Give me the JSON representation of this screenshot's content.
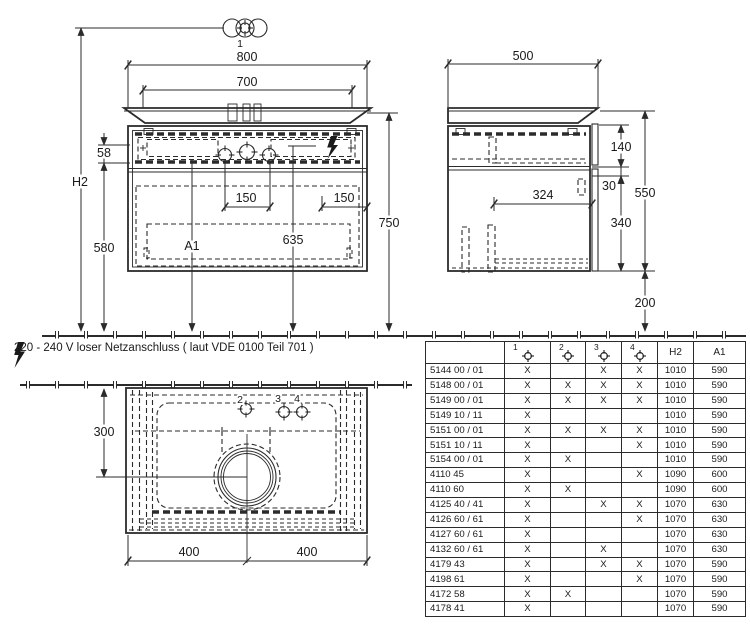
{
  "note": {
    "voltage_text": "220 - 240 V loser Netzanschluss ( laut VDE 0100 Teil 701 )"
  },
  "views": {
    "front": {
      "labels": {
        "hole1": "1",
        "w800": "800",
        "w700": "700",
        "h58": "58",
        "hH2": "H2",
        "h580": "580",
        "h750": "750",
        "d150_left": "150",
        "d150_right": "150",
        "a1": "A1",
        "d635": "635"
      }
    },
    "side": {
      "labels": {
        "w500": "500",
        "d140": "140",
        "d30": "30",
        "d340": "340",
        "d550": "550",
        "d200": "200",
        "d324": "324"
      }
    },
    "plan": {
      "labels": {
        "d300": "300",
        "d400_left": "400",
        "d400_right": "400",
        "hole2": "2",
        "hole3": "3",
        "hole4": "4"
      }
    }
  },
  "table": {
    "hole_headers": [
      "1",
      "2",
      "3",
      "4"
    ],
    "text_headers": [
      "H2",
      "A1"
    ],
    "rows": [
      {
        "article": "5144 00 / 01",
        "c1": "X",
        "c2": "",
        "c3": "X",
        "c4": "X",
        "h2": "1010",
        "a1": "590"
      },
      {
        "article": "5148 00 / 01",
        "c1": "X",
        "c2": "X",
        "c3": "X",
        "c4": "X",
        "h2": "1010",
        "a1": "590"
      },
      {
        "article": "5149 00 / 01",
        "c1": "X",
        "c2": "X",
        "c3": "X",
        "c4": "X",
        "h2": "1010",
        "a1": "590"
      },
      {
        "article": "5149 10 / 11",
        "c1": "X",
        "c2": "",
        "c3": "",
        "c4": "",
        "h2": "1010",
        "a1": "590"
      },
      {
        "article": "5151 00 / 01",
        "c1": "X",
        "c2": "X",
        "c3": "X",
        "c4": "X",
        "h2": "1010",
        "a1": "590"
      },
      {
        "article": "5151 10 / 11",
        "c1": "X",
        "c2": "",
        "c3": "",
        "c4": "X",
        "h2": "1010",
        "a1": "590"
      },
      {
        "article": "5154 00 / 01",
        "c1": "X",
        "c2": "X",
        "c3": "",
        "c4": "",
        "h2": "1010",
        "a1": "590"
      },
      {
        "article": "4110 45",
        "c1": "X",
        "c2": "",
        "c3": "",
        "c4": "X",
        "h2": "1090",
        "a1": "600"
      },
      {
        "article": "4110 60",
        "c1": "X",
        "c2": "X",
        "c3": "",
        "c4": "",
        "h2": "1090",
        "a1": "600"
      },
      {
        "article": "4125 40 / 41",
        "c1": "X",
        "c2": "",
        "c3": "X",
        "c4": "X",
        "h2": "1070",
        "a1": "630"
      },
      {
        "article": "4126 60 / 61",
        "c1": "X",
        "c2": "",
        "c3": "",
        "c4": "X",
        "h2": "1070",
        "a1": "630"
      },
      {
        "article": "4127 60 / 61",
        "c1": "X",
        "c2": "",
        "c3": "",
        "c4": "",
        "h2": "1070",
        "a1": "630"
      },
      {
        "article": "4132 60 / 61",
        "c1": "X",
        "c2": "",
        "c3": "X",
        "c4": "",
        "h2": "1070",
        "a1": "630"
      },
      {
        "article": "4179 43",
        "c1": "X",
        "c2": "",
        "c3": "X",
        "c4": "X",
        "h2": "1070",
        "a1": "590"
      },
      {
        "article": "4198 61",
        "c1": "X",
        "c2": "",
        "c3": "",
        "c4": "X",
        "h2": "1070",
        "a1": "590"
      },
      {
        "article": "4172 58",
        "c1": "X",
        "c2": "X",
        "c3": "",
        "c4": "",
        "h2": "1070",
        "a1": "590"
      },
      {
        "article": "4178 41",
        "c1": "X",
        "c2": "",
        "c3": "",
        "c4": "",
        "h2": "1070",
        "a1": "590"
      }
    ]
  }
}
